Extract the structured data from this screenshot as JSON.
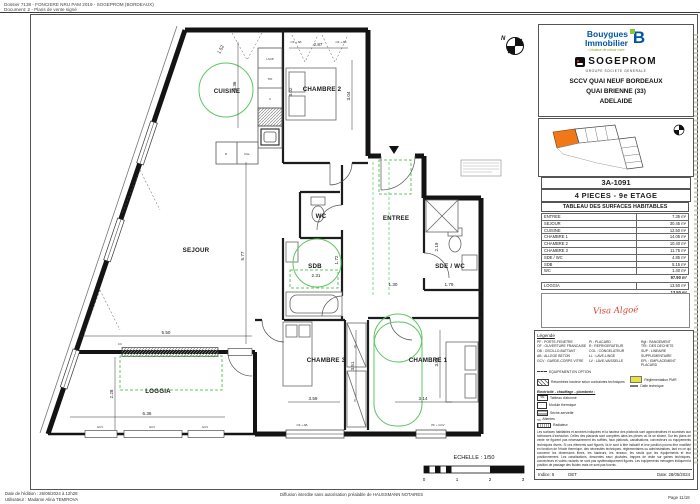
{
  "meta": {
    "header_line1": "Dossier 7138 - FONCIERE NRU PAM 2019 - SOGEPROM (BORDEAUX)",
    "header_line2": "Document: 2 - Plans de vente signé",
    "footer_left1": "Date de l'édition : 26/06/2024 à 12h28",
    "footer_left2": "Utilisateur : Madame Alina TEMIROVA",
    "footer_center": "Diffusion interdite sans autorisation préalable de HAUSSMANN NOTAIRES",
    "footer_right": "Page 11/18"
  },
  "title_block": {
    "brand1_line1": "Bouygues",
    "brand1_line2": "Immobilier",
    "brand1_tagline": "Créateur de mieux vivre",
    "brand1_mark": "B",
    "brand2": "SOGEPROM",
    "brand2_sub": "GROUPE SOCIETE GENERALE",
    "project_line1": "SCCV QUAI NEUF BORDEAUX",
    "project_line2": "QUAI BRIENNE (33)",
    "project_line3": "ADELAIDE",
    "plan_number": "3A-1091",
    "plan_type": "4 PIECES  -  9e ETAGE",
    "visa": "Visa Algoé",
    "indice_label": "Indice: 5",
    "indice_value": "DET",
    "date_label": "Date: 28/05/2024"
  },
  "surface_table": {
    "title": "TABLEAU DES SURFACES HABITABLES",
    "rows": [
      [
        "ENTREE",
        "7.35 m²"
      ],
      [
        "SEJOUR",
        "30.45 m²"
      ],
      [
        "CUISINE",
        "12.50 m²"
      ],
      [
        "CHAMBRE 1",
        "14.05 m²"
      ],
      [
        "CHAMBRE 2",
        "10.40 m²"
      ],
      [
        "CHAMBRE 3",
        "11.75 m²"
      ],
      [
        "SDE / WC",
        "4.85 m²"
      ],
      [
        "SDB",
        "5.15 m²"
      ],
      [
        "WC",
        "1.40 m²"
      ]
    ],
    "total": "97.90 m²",
    "loggia_label": "LOGGIA",
    "loggia_value": "13.50 m²",
    "loggia_total": "13.50 m²"
  },
  "legend": {
    "title": "Légende",
    "col1": [
      "PF : PORTE-FENETRE",
      "OF : OUVERTURE FRANCAISE",
      "OB : OSCILLO-BATTANT",
      "AB : ALLEGE BETON",
      "GCV : GARDE-CORPS VITRE"
    ],
    "col2": [
      "Pl : PLACARD",
      "R : REFRIGERATEUR",
      "CGL : CONGELATEUR",
      "LL : LAVE-LINGE",
      "LV : LAVE-VAISSELLE"
    ],
    "col3": [
      "Rgt : RANGEMENT",
      "TRI : DES DECHETS",
      "SUP : LINEAIRE SUPPLEMENTAIRE",
      "EPL : EMPLACEMENT PLACARD"
    ],
    "option_line": "EQUIPEMENT EN OPTION",
    "hatch_label": "Retombées hauteur selon contraintes techniques",
    "pmr_label": "Réglementation PMR",
    "dalle_label": "Dalle technique",
    "electric_title": "Electricité - chauffage - plomberie :",
    "sym_tal_key": "TAL",
    "sym_tal": "Tableau d'abonné",
    "sym_module": "Module thermique",
    "sym_seche": "Sèche-serviette",
    "sym_attentes": "Attentes",
    "sym_radiateur": "Radiateur",
    "disclaimer": "Les surfaces habitables et annexes indiquées et la hauteur des plafonds sont approximatives et soumises aux tolérances d'exécution. Celles des placards sont comptées dans les pièces où ils se situent. Sur les plans de vente ne figurent pas nécessairement les soffites, faux plafonds, canalisations, convecteurs ou équipements techniques divers. Si ces éléments sont figurés, ils le sont à titre indicatif et leur position pourra être modifiée en fonction de l'étude thermique, des nécessités techniques, réglementaires ou administratives, tant en ce qui concerne les dimensions libres, les hauteurs, les niveaux, les seuils que les équipements et leur positionnement. Les canalisations, descentes eaux pluviales, trappes de visite sur gaines techniques, convecteurs et volets roulants ne sont pas systématiquement figurés. Les équipements ménagers indiquent la position de passage des fluides mais ne sont pas fournis."
  },
  "plan": {
    "north": "N",
    "room_labels": [
      "CUISINE",
      "CHAMBRE 2",
      "SEJOUR",
      "ENTREE",
      "WC",
      "SDB",
      "SDE / WC",
      "CHAMBRE 3",
      "CHAMBRE 1",
      "LOGGIA"
    ],
    "dims": [
      "1.52",
      "3.36",
      "2.87",
      "3.02",
      "3.04",
      "5.77",
      "5.50",
      "2.28",
      "6.36",
      "1.72",
      "2.31",
      "2.19",
      "1.30",
      "1.79",
      "3.51",
      "3.59",
      "3.84",
      "3.14"
    ],
    "fixtures": [
      "LSUP",
      "TRI",
      "C",
      "R",
      "CGL",
      "Pl.",
      "Pl.",
      "GCV",
      "GCV",
      "GCV",
      "CC",
      "OF + AB",
      "OF + AB",
      "OF + AB",
      "PF + GCV"
    ],
    "scale_label": "ECHELLE : 1/50",
    "scale_ticks": [
      "0",
      "1",
      "2",
      "3"
    ]
  }
}
